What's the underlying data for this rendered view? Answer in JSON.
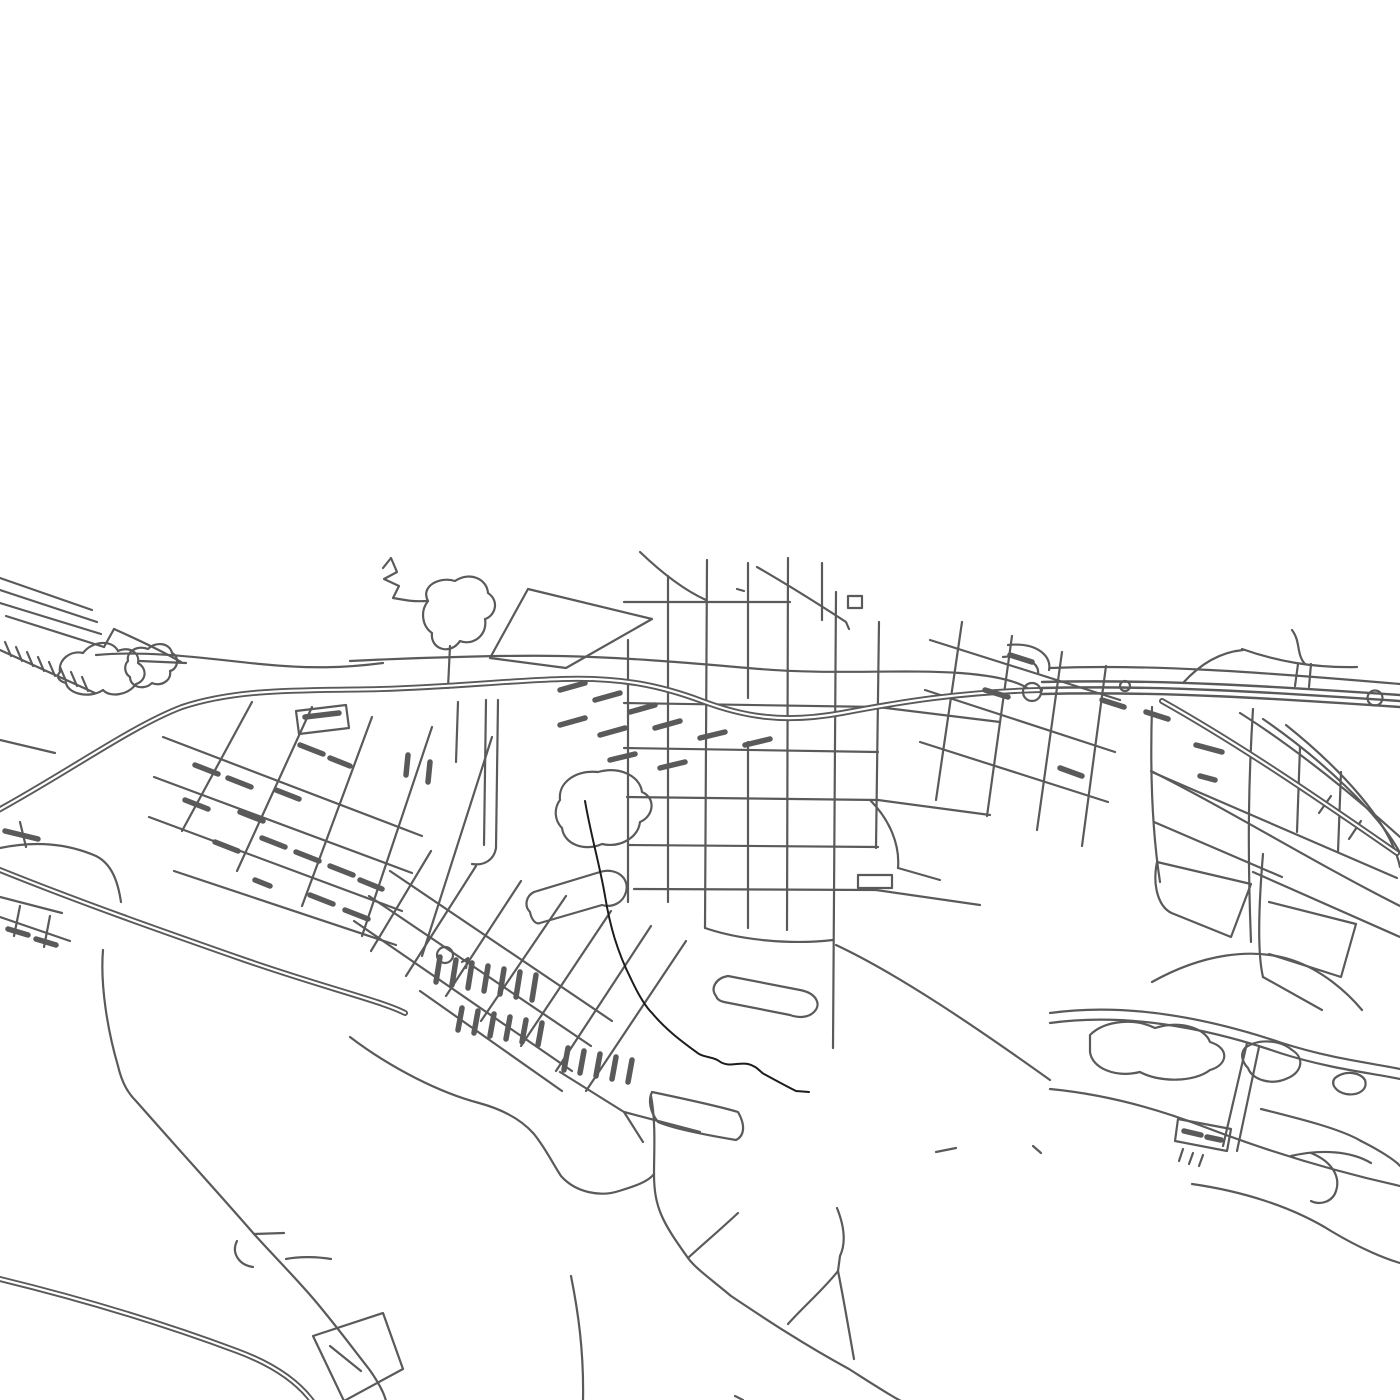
{
  "map": {
    "type": "street-map-line-art",
    "background_color": "#ffffff",
    "road_color": "#5a5a5a",
    "water_color": "#1c1c1c",
    "canvas": {
      "width": 1400,
      "height": 1400
    },
    "layers": [
      {
        "name": "minor-roads",
        "stroke": "#5a5a5a",
        "width": 2.2,
        "paths": [
          "M0,578 L92,610",
          "M0,590 L97,622",
          "M0,603 L101,634",
          "M6,616 L104,647",
          "M104,647 L114,629",
          "M114,629 C141,641 162,651 181,662",
          "M5,642 L11,656",
          "M16,647 L22,661",
          "M27,652 L33,666",
          "M38,657 L44,671",
          "M49,662 L55,676",
          "M60,667 L66,681",
          "M71,672 L77,686",
          "M82,677 L88,691",
          "M0,650 L95,693",
          "M60,672 C58,660 70,650 83,653 C92,641 112,639 118,651 C130,646 140,653 138,663 C148,669 146,681 136,684 C128,695 110,698 103,690 C90,699 68,694 66,683 C58,681 56,676 60,672 Z",
          "M128,661 C126,651 138,645 148,649 C156,641 170,643 172,653 C180,657 178,669 170,671 C172,681 160,687 152,683 C144,691 130,687 130,677 C124,673 124,665 128,661 Z",
          "M140,661 L186,663",
          "M96,655 C150,650 210,659 260,664 C310,669 345,668 383,663",
          "M383,568 L391,558 L397,572 L384,579 L399,586 L393,598 L405,600",
          "M405,600 C415,602 422,601 428,601",
          "M428,601 C420,586 440,576 455,581 C470,571 487,579 488,593 C500,601 495,616 485,619 C488,636 472,646 460,641 C450,656 430,649 432,633 C422,626 420,611 428,601 Z",
          "M450,646 L448,688",
          "M490,658 L528,589 L652,619 L566,668 Z",
          "M640,552 C663,574 686,591 706,600",
          "M757,567 C795,589 823,607 846,622 L849,629",
          "M737,589 L744,591",
          "M1292,630 C1301,642 1296,654 1305,664",
          "M1242,649 C1276,661 1312,668 1357,667",
          "M1298,664 L1295,686",
          "M1311,664 L1309,687",
          "M1183,683 C1202,662 1222,652 1243,650",
          "M628,640 L628,902",
          "M668,576 L668,902",
          "M707,560 L705,928",
          "M748,563 L748,698",
          "M748,742 L748,928",
          "M788,558 L787,930",
          "M836,592 L833,1048",
          "M879,622 L876,848",
          "M624,602 L790,602",
          "M624,703 L878,707",
          "M624,748 L878,752",
          "M627,797 L878,800",
          "M629,845 L878,847",
          "M634,889 L876,890",
          "M878,707 L1000,722",
          "M878,800 L990,815",
          "M876,890 L980,905",
          "M705,928 C740,940 790,945 833,940",
          "M836,945 C900,975 980,1030 1050,1080",
          "M822,563 L822,620",
          "M848,596 L862,596 L862,608 L848,608 Z",
          "M858,875 L892,875 L892,888 L858,888 Z",
          "M870,800 C890,820 900,845 898,868",
          "M898,868 L940,880",
          "M930,640 L1120,700",
          "M925,690 L1115,752",
          "M920,742 L1108,802",
          "M962,622 L936,800",
          "M1012,636 L987,816",
          "M1062,652 L1037,830",
          "M1106,666 L1082,846",
          "M1008,645 C1038,642 1052,657 1049,670",
          "M1003,657 C1026,654 1040,664 1038,674",
          "M350,661 C430,657 520,655 560,656 C640,658 700,664 760,669 C830,675 900,669 960,673 C1000,676 1020,682 1030,690",
          "M0,740 L55,753",
          "M0,848 C35,841 66,843 96,856 C112,864 118,882 121,902",
          "M0,897 L62,913",
          "M20,906 L14,936",
          "M50,916 L44,947",
          "M0,917 L70,941",
          "M20,822 L26,847",
          "M163,737 L422,836",
          "M154,777 L412,873",
          "M149,817 L402,911",
          "M174,871 L396,945",
          "M252,702 L182,831",
          "M312,707 L237,871",
          "M372,717 L302,906",
          "M432,727 L362,936",
          "M492,737 L422,956",
          "M296,711 L346,705 L349,728 L299,734 Z",
          "M486,700 L484,845",
          "M498,700 L496,848",
          "M496,848 C494,860 484,866 472,864",
          "M458,702 L456,762",
          "M560,800 C558,782 576,770 598,772 C620,766 640,776 642,792 C656,798 654,816 640,822 C638,838 620,848 602,844 C584,852 564,844 562,828 C554,820 554,808 560,800 Z",
          "M390,871 L612,1021",
          "M369,896 L591,1046",
          "M354,921 L572,1071",
          "M420,991 L562,1091",
          "M431,851 L371,951",
          "M476,866 L406,976",
          "M521,881 L446,996",
          "M566,896 L481,1021",
          "M611,911 L521,1046",
          "M651,926 L556,1071",
          "M686,941 L586,1091",
          "M530,912 C524,906 526,896 534,892 L600,872 C616,867 630,878 626,892 C623,903 612,908 602,905 L540,923 C535,925 531,918 530,912 Z",
          "M462,962 L468,958 L466,968",
          "M560,1072 L624,1112 L700,1132",
          "M624,1112 L643,1142",
          "M652,1092 C690,1100 725,1108 738,1112 C746,1126 744,1136 736,1140 C700,1134 672,1128 658,1122 C650,1112 648,1100 652,1092 Z",
          "M716,996 C710,988 716,978 728,976 L800,990 C816,993 822,1004 814,1012 C808,1018 798,1018 790,1015 L724,1002 C719,1001 717,999 716,996 Z",
          "M350,1037 C392,1069 441,1093 479,1103 C501,1109 521,1119 534,1134 C546,1149 553,1164 561,1176 C576,1193 601,1197 619,1191 C636,1186 649,1181 654,1174",
          "M651,1096 C656,1122 654,1152 654,1174",
          "M654,1174 C654,1208 663,1223 688,1258 C696,1269 711,1279 731,1296 C761,1316 801,1343 849,1369 C871,1383 891,1396 901,1401",
          "M688,1258 C701,1246 721,1229 738,1213",
          "M837,1208 C843,1223 847,1241 840,1256 L838,1271",
          "M838,1271 C824,1289 804,1306 788,1324",
          "M838,1271 C844,1301 849,1331 854,1359",
          "M571,1276 C578,1311 584,1351 583,1401",
          "M735,1396 L743,1400",
          "M1033,1146 L1041,1153",
          "M936,1152 L956,1148",
          "M103,950 C100,986 108,1032 118,1066 C122,1083 128,1093 136,1101 C180,1151 221,1196 254,1234 C271,1253 291,1273 311,1296 C331,1319 351,1346 369,1369 C379,1383 384,1393 386,1401",
          "M254,1234 L284,1233",
          "M237,1241 C231,1253 239,1265 253,1267",
          "M286,1259 C301,1256 319,1257 331,1259",
          "M313,1336 L383,1313 L403,1369 L344,1401 Z",
          "M330,1346 L361,1371",
          "M1152,707 C1150,770 1152,830 1160,882",
          "M1253,709 C1249,772 1247,842 1251,942",
          "M1152,772 L1397,878",
          "M1154,822 L1282,877",
          "M1253,872 L1400,937",
          "M1300,747 L1297,832",
          "M1341,772 L1338,852",
          "M1157,862 L1251,884 L1231,937 L1174,914 C1159,909 1152,887 1157,862 Z",
          "M1263,854 C1259,902 1257,952 1263,977",
          "M1263,977 L1322,1010",
          "M1269,902 L1356,924 L1341,977 L1269,954",
          "M1152,982 C1202,954 1252,947 1292,960 C1322,970 1347,992 1362,1010",
          "M1050,1013 C1122,1003 1202,1016 1282,1043 C1332,1059 1372,1063 1400,1069",
          "M1050,1023 C1122,1013 1202,1026 1280,1053 C1330,1069 1372,1073 1400,1079",
          "M1050,1089 C1092,1093 1142,1103 1202,1126 C1272,1153 1342,1173 1400,1186",
          "M1090,1035 C1105,1020 1135,1018 1155,1028 C1180,1020 1205,1028 1210,1042 C1230,1048 1228,1065 1210,1070 C1195,1082 1160,1083 1140,1072 C1115,1078 1092,1068 1090,1052 Z",
          "M1245,1048 C1258,1038 1280,1040 1292,1050 C1305,1058 1302,1072 1288,1078 C1272,1086 1252,1080 1248,1068 C1242,1062 1240,1054 1245,1048 Z",
          "M1335,1078 C1345,1070 1360,1072 1365,1080 C1368,1090 1358,1096 1346,1094 C1336,1092 1330,1084 1335,1078 Z",
          "M1247,1043 L1223,1146",
          "M1259,1047 L1237,1151",
          "M1178,1119 L1231,1129 L1227,1151 L1175,1141 Z",
          "M1183,1149 L1179,1161",
          "M1193,1153 L1189,1164",
          "M1203,1155 L1199,1166",
          "M1261,1109 C1301,1119 1341,1129 1361,1141",
          "M1291,1156 C1321,1149 1351,1151 1371,1163",
          "M1361,1141 C1381,1151 1396,1161 1400,1166",
          "M1192,1184 C1241,1191 1291,1206 1331,1231 C1361,1249 1386,1259 1400,1263",
          "M1311,1153 C1331,1161 1341,1176 1336,1191 C1333,1201 1321,1206 1311,1201",
          "M1240,713 C1300,751 1360,801 1400,837",
          "M1263,719 C1321,759 1379,813 1400,853",
          "M1286,725 C1341,769 1391,823 1400,867",
          "M1331,796 L1319,813",
          "M1361,821 L1349,839",
          "M1151,771 C1231,811 1311,861 1400,906",
          "M1050,668 C1150,664 1260,672 1400,684"
        ]
      },
      {
        "name": "motorway-casing",
        "stroke": "#5a5a5a",
        "width": 6,
        "paths": [
          "M-5,812 C70,771 132,726 182,707 C242,687 312,691 382,689 C452,687 502,681 562,679 C622,677 662,686 702,701 C742,716 782,724 842,713 C900,702 960,692 1040,690",
          "M0,870 C82,903 162,931 242,959 C322,987 382,1001 405,1013",
          "M0,1279 C82,1299 162,1323 237,1351 C272,1364 297,1381 312,1401",
          "M1162,701 C1242,746 1322,801 1397,853"
        ]
      },
      {
        "name": "motorway-inner",
        "stroke": "#ffffff",
        "width": 2.2,
        "paths": [
          "M-5,812 C70,771 132,726 182,707 C242,687 312,691 382,689 C452,687 502,681 562,679 C622,677 662,686 702,701 C742,716 782,724 842,713 C900,702 960,692 1040,690",
          "M0,870 C82,903 162,931 242,959 C322,987 382,1001 405,1013",
          "M0,1279 C82,1299 162,1323 237,1351 C272,1364 297,1381 312,1401",
          "M1162,701 C1242,746 1322,801 1397,853"
        ]
      },
      {
        "name": "trunk-band",
        "stroke": "#5a5a5a",
        "width": 2.4,
        "paths": [
          "M1042,682 C1162,679 1282,687 1400,695",
          "M1042,688 C1162,685 1282,693 1400,701",
          "M1042,694 C1162,691 1282,699 1400,707"
        ]
      },
      {
        "name": "building-bars",
        "stroke": "#5a5a5a",
        "width": 5.5,
        "paths": [
          "M305,717 L339,713",
          "M195,765 L218,774",
          "M228,778 L251,787",
          "M185,800 L208,809",
          "M240,812 L263,821",
          "M276,790 L299,799",
          "M300,745 L323,754",
          "M330,758 L350,766",
          "M262,838 L285,847",
          "M296,852 L319,861",
          "M330,866 L353,875",
          "M215,842 L238,851",
          "M360,880 L382,889",
          "M255,880 L270,886",
          "M310,895 L333,904",
          "M345,910 L368,919",
          "M408,755 L406,775",
          "M430,762 L428,782",
          "M560,690 L585,683",
          "M595,700 L620,693",
          "M630,712 L655,705",
          "M560,725 L585,718",
          "M600,735 L625,728",
          "M655,728 L680,721",
          "M700,738 L725,732",
          "M745,745 L770,739",
          "M610,760 L635,754",
          "M660,768 L685,762",
          "M1060,768 L1082,776",
          "M1196,745 L1222,752",
          "M1200,776 L1215,780",
          "M1102,700 L1124,707",
          "M1146,712 L1168,719",
          "M985,690 L1008,697",
          "M1010,655 L1032,662",
          "M5,831 L38,839",
          "M8,929 L28,935",
          "M36,939 L56,945",
          "M440,957 L436,982",
          "M456,960 L452,985",
          "M472,963 L468,988",
          "M488,966 L484,991",
          "M504,969 L500,994",
          "M520,972 L516,997",
          "M536,975 L532,1000",
          "M462,1008 L458,1030",
          "M478,1011 L474,1033",
          "M494,1014 L490,1036",
          "M510,1017 L506,1039",
          "M526,1020 L522,1042",
          "M542,1023 L538,1045",
          "M568,1048 L564,1070",
          "M584,1051 L580,1073",
          "M600,1054 L596,1076",
          "M616,1057 L612,1079",
          "M632,1060 L628,1082",
          "M1184,1131 L1201,1135",
          "M1207,1137 L1221,1140"
        ]
      },
      {
        "name": "roundabouts",
        "stroke": "#5a5a5a",
        "width": 2.2,
        "paths": [
          "M437,955 a8,8 0 1 0 16,0 a8,8 0 1 0 -16,0",
          "M1023,692 a9,9 0 1 0 18,0 a9,9 0 1 0 -18,0",
          "M1120,686 a5,5 0 1 0 10,0 a5,5 0 1 0 -10,0",
          "M1367.5,698 a7.5,7.5 0 1 0 15,0 a7.5,7.5 0 1 0 -15,0"
        ]
      },
      {
        "name": "stream",
        "stroke": "#1c1c1c",
        "width": 2,
        "paths": [
          "M585,801 C591,836 600,866 605,896 C610,926 617,951 631,979 C639,996 645,1006 652,1013 C667,1031 684,1043 699,1054 C707,1058 714,1057 719,1061 C728,1068 738,1062 748,1064 C757,1066 760,1072 764,1074 C775,1080 786,1086 796,1091 L809,1092"
        ]
      }
    ]
  }
}
